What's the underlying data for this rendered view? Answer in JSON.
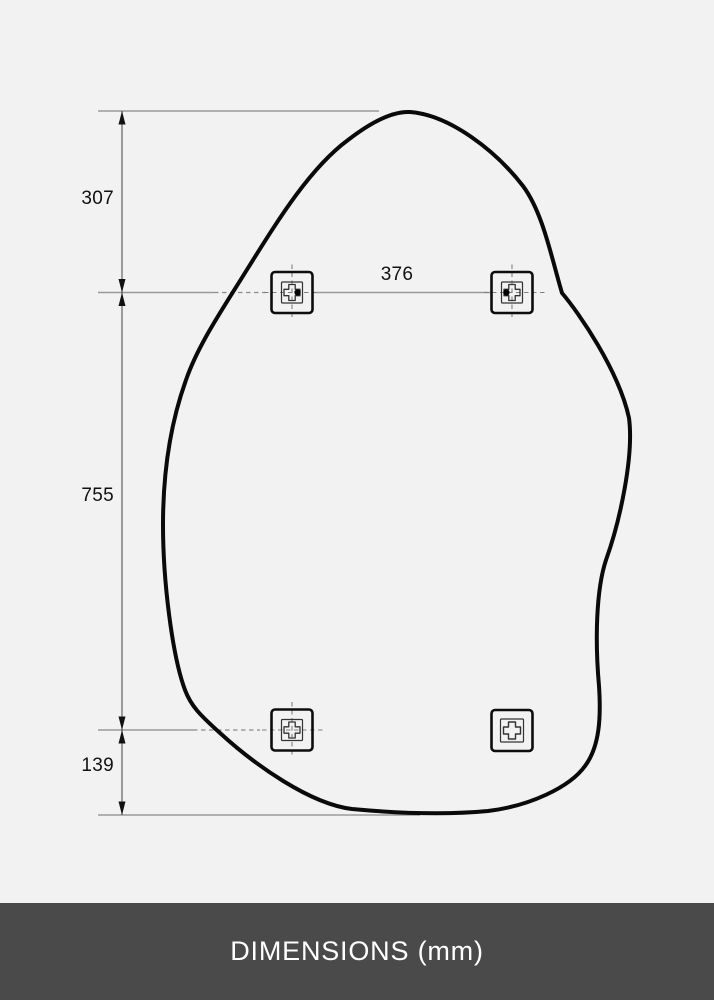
{
  "page": {
    "background_color": "#f2f2f2",
    "accent_line_color": "#999999",
    "outline_color": "#0a0a0a"
  },
  "footer": {
    "label": "DIMENSIONS (mm)",
    "background_color": "#4a4a4a",
    "text_color": "#ffffff"
  },
  "diagram": {
    "type": "product-dimension-drawing",
    "subject": "organic-shaped mirror outline with wall-mount brackets",
    "unit": "mm",
    "dimensions": {
      "top_to_upper_brackets": "307",
      "upper_to_lower_brackets": "755",
      "lower_brackets_to_bottom": "139",
      "bracket_horizontal_spacing": "376"
    },
    "brackets": [
      {
        "position": "top-left",
        "icon": "mounting-bracket-icon",
        "has_dot": true,
        "has_crosshair": true
      },
      {
        "position": "top-right",
        "icon": "mounting-bracket-icon",
        "has_dot": true,
        "has_crosshair": true
      },
      {
        "position": "bottom-left",
        "icon": "mounting-bracket-icon",
        "has_dot": false,
        "has_crosshair": true
      },
      {
        "position": "bottom-right",
        "icon": "mounting-bracket-icon",
        "has_dot": false,
        "has_crosshair": false
      }
    ]
  }
}
